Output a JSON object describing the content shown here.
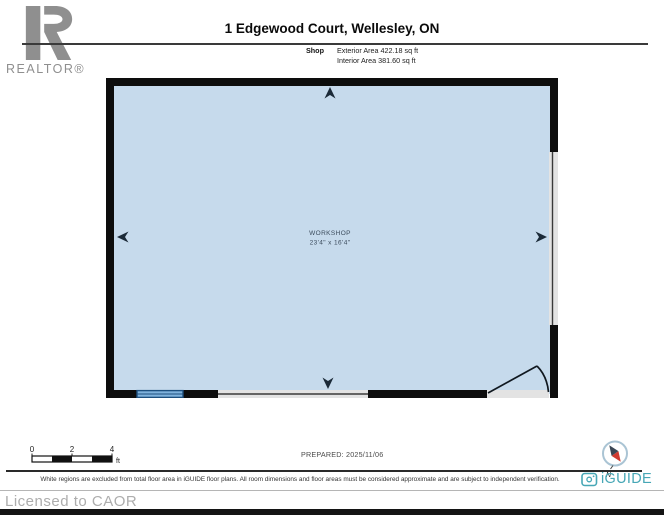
{
  "page": {
    "title": "1 Edgewood Court, Wellesley, ON"
  },
  "branding": {
    "realtor_logo_text": "REALTOR®",
    "iguide_name": "iGUIDE",
    "iguide_color": "#47a7b6",
    "license_text": "Licensed to CAOR"
  },
  "unit_summary": {
    "name": "Shop",
    "exterior_area": "Exterior Area 422.18 sq ft",
    "interior_area": "Interior Area 381.60 sq ft"
  },
  "floorplan": {
    "room_name": "WORKSHOP",
    "room_dimensions": "23'4\" x 16'4\"",
    "colors": {
      "interior_fill": "#c6daec",
      "wall": "#0d0d0d",
      "window": "#7fb2dc",
      "window_frame": "#1d4f7e",
      "opening_fill": "#e3e3e3",
      "opening_line": "#3a3a3a",
      "arrow": "#1b2a38",
      "label_text": "#3b4b5c"
    }
  },
  "scale_bar": {
    "tick_labels": [
      "0",
      "2",
      "4"
    ],
    "unit": "ft"
  },
  "compass": {
    "north_label": "N"
  },
  "footer": {
    "prepared_label": "PREPARED: 2025/11/06",
    "disclaimer": "White regions are excluded from total floor area in iGUIDE floor plans. All room dimensions and floor areas must be considered approximate and are subject to independent verification."
  }
}
